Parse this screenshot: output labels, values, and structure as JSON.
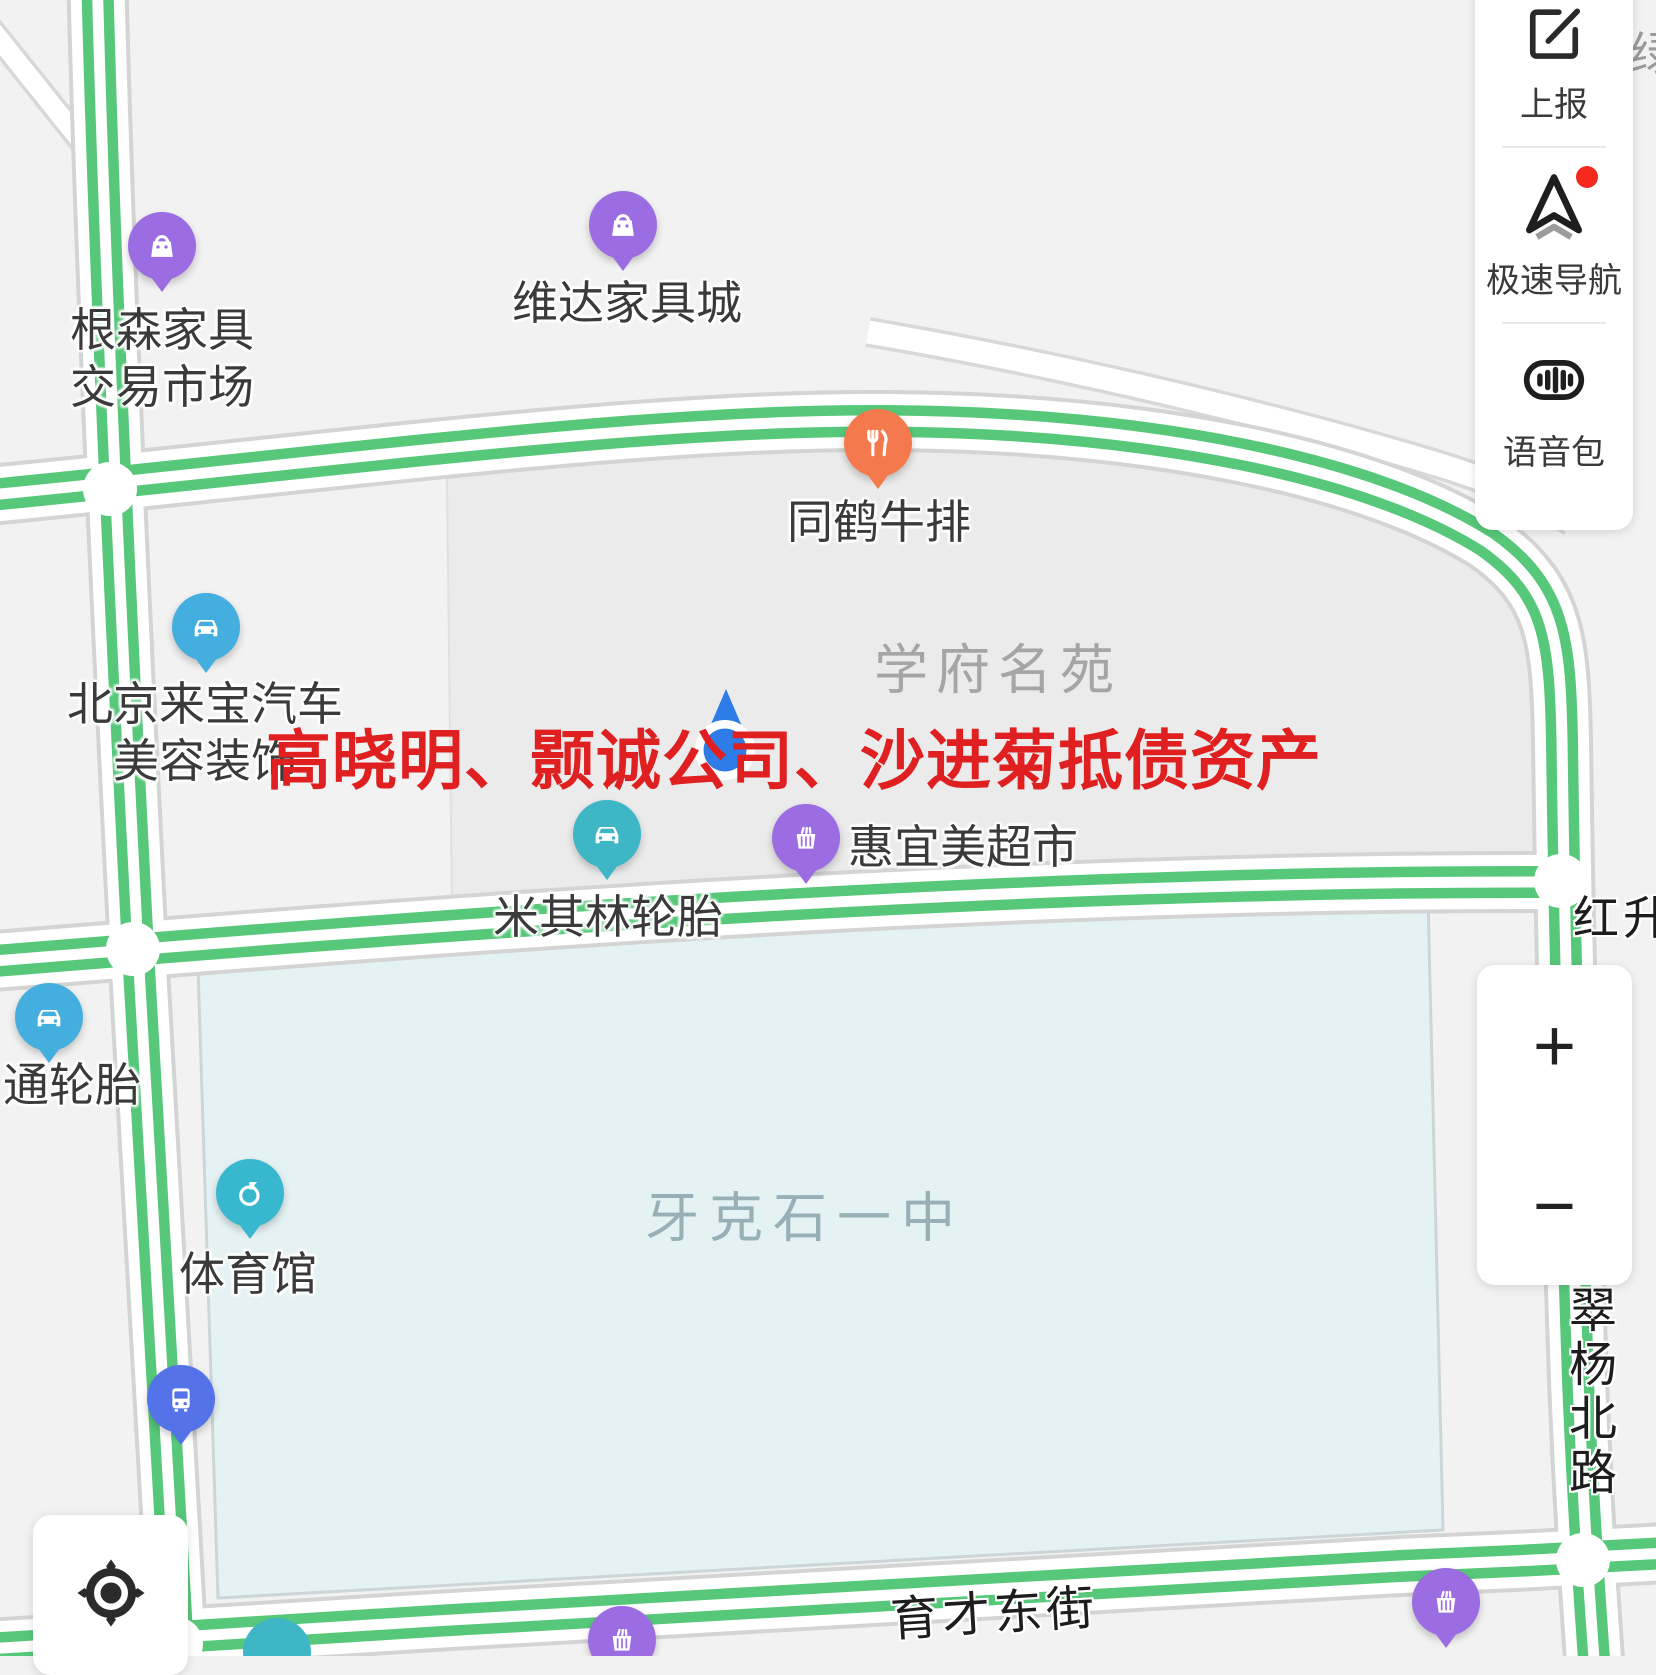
{
  "watermark": {
    "text": "高晓明、颢诚公司、沙进菊抵债资产",
    "color": "#e02020"
  },
  "side_panel": {
    "items": [
      {
        "id": "report",
        "label": "上报",
        "icon": "edit-icon",
        "badge": false
      },
      {
        "id": "nav",
        "label": "极速导航",
        "icon": "navigation-icon",
        "badge": true
      },
      {
        "id": "voice",
        "label": "语音包",
        "icon": "voice-icon",
        "badge": false
      }
    ]
  },
  "zoom_controls": {
    "zoom_in": "+",
    "zoom_out": "−"
  },
  "map": {
    "area_labels": [
      {
        "text": "学府名苑",
        "x": 998,
        "y": 665,
        "font": 54,
        "color": "#a5a5a5",
        "spacing": 8
      },
      {
        "text": "牙克石一中",
        "x": 805,
        "y": 1213,
        "font": 54,
        "color": "#97b0b5",
        "spacing": 10
      }
    ],
    "road_labels": [
      {
        "text": "红升",
        "x": 1573,
        "y": 882,
        "font": 46,
        "vertical": false,
        "rotate": 0
      },
      {
        "text": "翠杨北路",
        "x": 1580,
        "y": 1285,
        "font": 48,
        "vertical": true,
        "rotate": 0
      },
      {
        "text": "育才东街",
        "x": 1000,
        "y": 1602,
        "font": 48,
        "vertical": false,
        "rotate": -3.5
      }
    ],
    "corner_label": {
      "text": "绿"
    },
    "pois": [
      {
        "label_lines": [
          "根森家具",
          "交易市场"
        ],
        "icon": "bag",
        "color": "#9c6ce2",
        "x": 162,
        "y": 246,
        "lx": 162,
        "ly": 330,
        "align": "center"
      },
      {
        "label_lines": [
          "维达家具城"
        ],
        "icon": "bag",
        "color": "#9c6ce2",
        "x": 623,
        "y": 225,
        "lx": 627,
        "ly": 303,
        "align": "center"
      },
      {
        "label_lines": [
          "同鹤牛排"
        ],
        "icon": "restaurant",
        "color": "#f4794d",
        "x": 878,
        "y": 443,
        "lx": 879,
        "ly": 522,
        "align": "center"
      },
      {
        "label_lines": [
          "北京来宝汽车",
          "美容装饰"
        ],
        "icon": "car",
        "color": "#44aede",
        "x": 206,
        "y": 627,
        "lx": 205,
        "ly": 704,
        "align": "center"
      },
      {
        "label_lines": [
          "米其林轮胎"
        ],
        "icon": "car",
        "color": "#3eb6c6",
        "x": 607,
        "y": 834,
        "lx": 608,
        "ly": 917,
        "align": "center"
      },
      {
        "label_lines": [
          "惠宜美超市"
        ],
        "icon": "basket",
        "color": "#9c6ce2",
        "x": 806,
        "y": 838,
        "lx": 848,
        "ly": 847,
        "align": "left"
      },
      {
        "label_lines": [
          "通轮胎"
        ],
        "icon": "car",
        "color": "#44aede",
        "x": 49,
        "y": 1017,
        "lx": 72,
        "ly": 1085,
        "align": "center"
      },
      {
        "label_lines": [
          "体育馆"
        ],
        "icon": "sport",
        "color": "#38b8cf",
        "x": 250,
        "y": 1193,
        "lx": 248,
        "ly": 1274,
        "align": "center"
      },
      {
        "label_lines": [],
        "icon": "bus",
        "color": "#5573e8",
        "x": 181,
        "y": 1399
      },
      {
        "label_lines": [],
        "icon": "basket",
        "color": "#9c6ce2",
        "x": 622,
        "y": 1640
      },
      {
        "label_lines": [],
        "icon": "basket",
        "color": "#9c6ce2",
        "x": 1446,
        "y": 1602
      }
    ],
    "partial_markers": [
      {
        "color": "#3eb6c6",
        "x": 277,
        "y": 1652
      }
    ]
  },
  "colors": {
    "bg": "#f2f2f2",
    "road_green": "#57c87a",
    "road_casing": "#d4d4d4",
    "block_fill": "#ebebeb",
    "school_fill": "#e5f2f4",
    "location_blue": "#2e7ce8"
  }
}
